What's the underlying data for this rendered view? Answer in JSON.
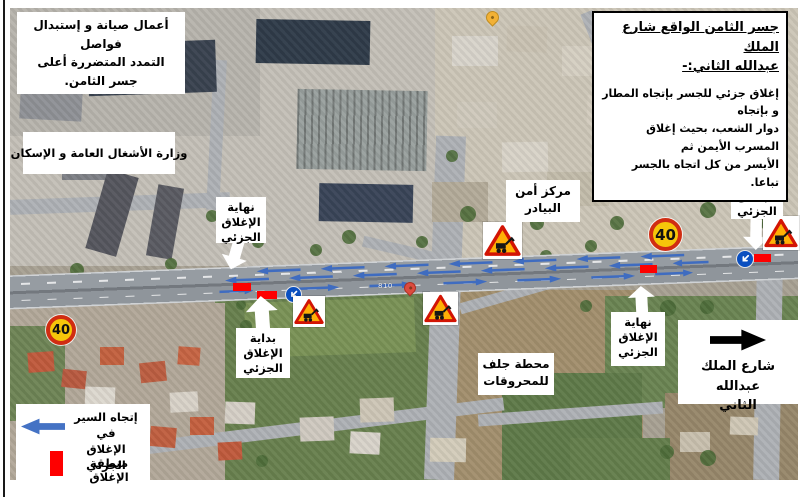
{
  "maintenance_note": {
    "lines": [
      "أعمال صيانة و إستبدال فواصل",
      "التمدد المتضررة أعلى جسر الثامن."
    ]
  },
  "closure_notice": {
    "title_lines": [
      "جسر الثامن الواقع  شارع الملك",
      "عبدالله الثاني:-"
    ],
    "body_lines": [
      "إغلاق جزئي للجسر بإتجاه المطار و بإتجاه",
      "دوار الشعب، بحيث إغلاق المسرب الأيمن ثم",
      "الأيسر من كل اتجاه بالجسر تباعا."
    ]
  },
  "map_labels": {
    "ministry": "وزارة الأشغال العامة و الإسكان",
    "security_center_lines": [
      "مركز أمن",
      "البيادر"
    ],
    "fuel_station_lines": [
      "محطة جلف",
      "للمحروقات"
    ],
    "street_sign_lines": [
      "شارع الملك عبدالله",
      "الثاني"
    ],
    "road_number": "810"
  },
  "closure_callouts": {
    "end_lines": [
      "نهاية",
      "الإغلاق",
      "الجزئي"
    ],
    "start_lines": [
      "بداية",
      "الإغلاق",
      "الجزئي"
    ]
  },
  "legend": {
    "direction_lines": [
      "إتجاه السير في",
      "الإغلاق الجزئي"
    ],
    "closure_area": "منطقة الإغلاق"
  },
  "signs": {
    "speed_limit": "40"
  },
  "icons": {
    "roadworks_sign": "roadworks-warning-triangle-icon",
    "keep_left_sign": "keep-left-blue-circle-icon",
    "traffic_arrow": "traffic-direction-arrow-icon",
    "legend_arrow": "left-arrow-icon",
    "street_arrow": "right-arrow-icon",
    "callout_arrow": "white-callout-arrow-icon",
    "map_pins": "map-pin-icon"
  },
  "colors": {
    "traffic_arrow_blue": "#3f6cc0",
    "closure_red": "#fe0000",
    "speed_sign_yellow": "#f6c60a",
    "speed_sign_ring_red": "#d02d12",
    "warning_fill": "#ffb006",
    "warning_border": "#d21404",
    "mandatory_sign_blue": "#0a4fc0"
  }
}
